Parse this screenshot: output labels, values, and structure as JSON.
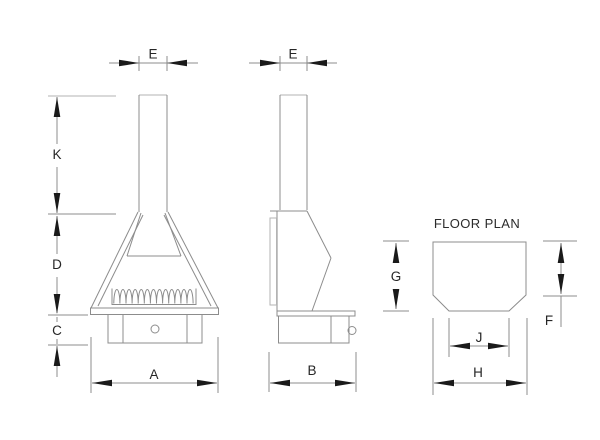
{
  "drawing": {
    "floor_plan_title": "FLOOR PLAN",
    "front_view": {
      "flue_width_label": "E",
      "flue_height_label": "K",
      "hood_height_label": "D",
      "base_height_label": "C",
      "overall_width_label": "A"
    },
    "side_view": {
      "flue_width_label": "E",
      "overall_depth_label": "B"
    },
    "floor_plan": {
      "overall_depth_label": "G",
      "depth_to_chamfer_label": "F",
      "front_width_label": "J",
      "overall_width_label": "H"
    }
  },
  "colors": {
    "drawing_line": "#8c8c8c",
    "light_line": "#b3b3b3",
    "arrowhead": "#1a1a1a",
    "label_text": "#262626",
    "background": "#ffffff"
  }
}
